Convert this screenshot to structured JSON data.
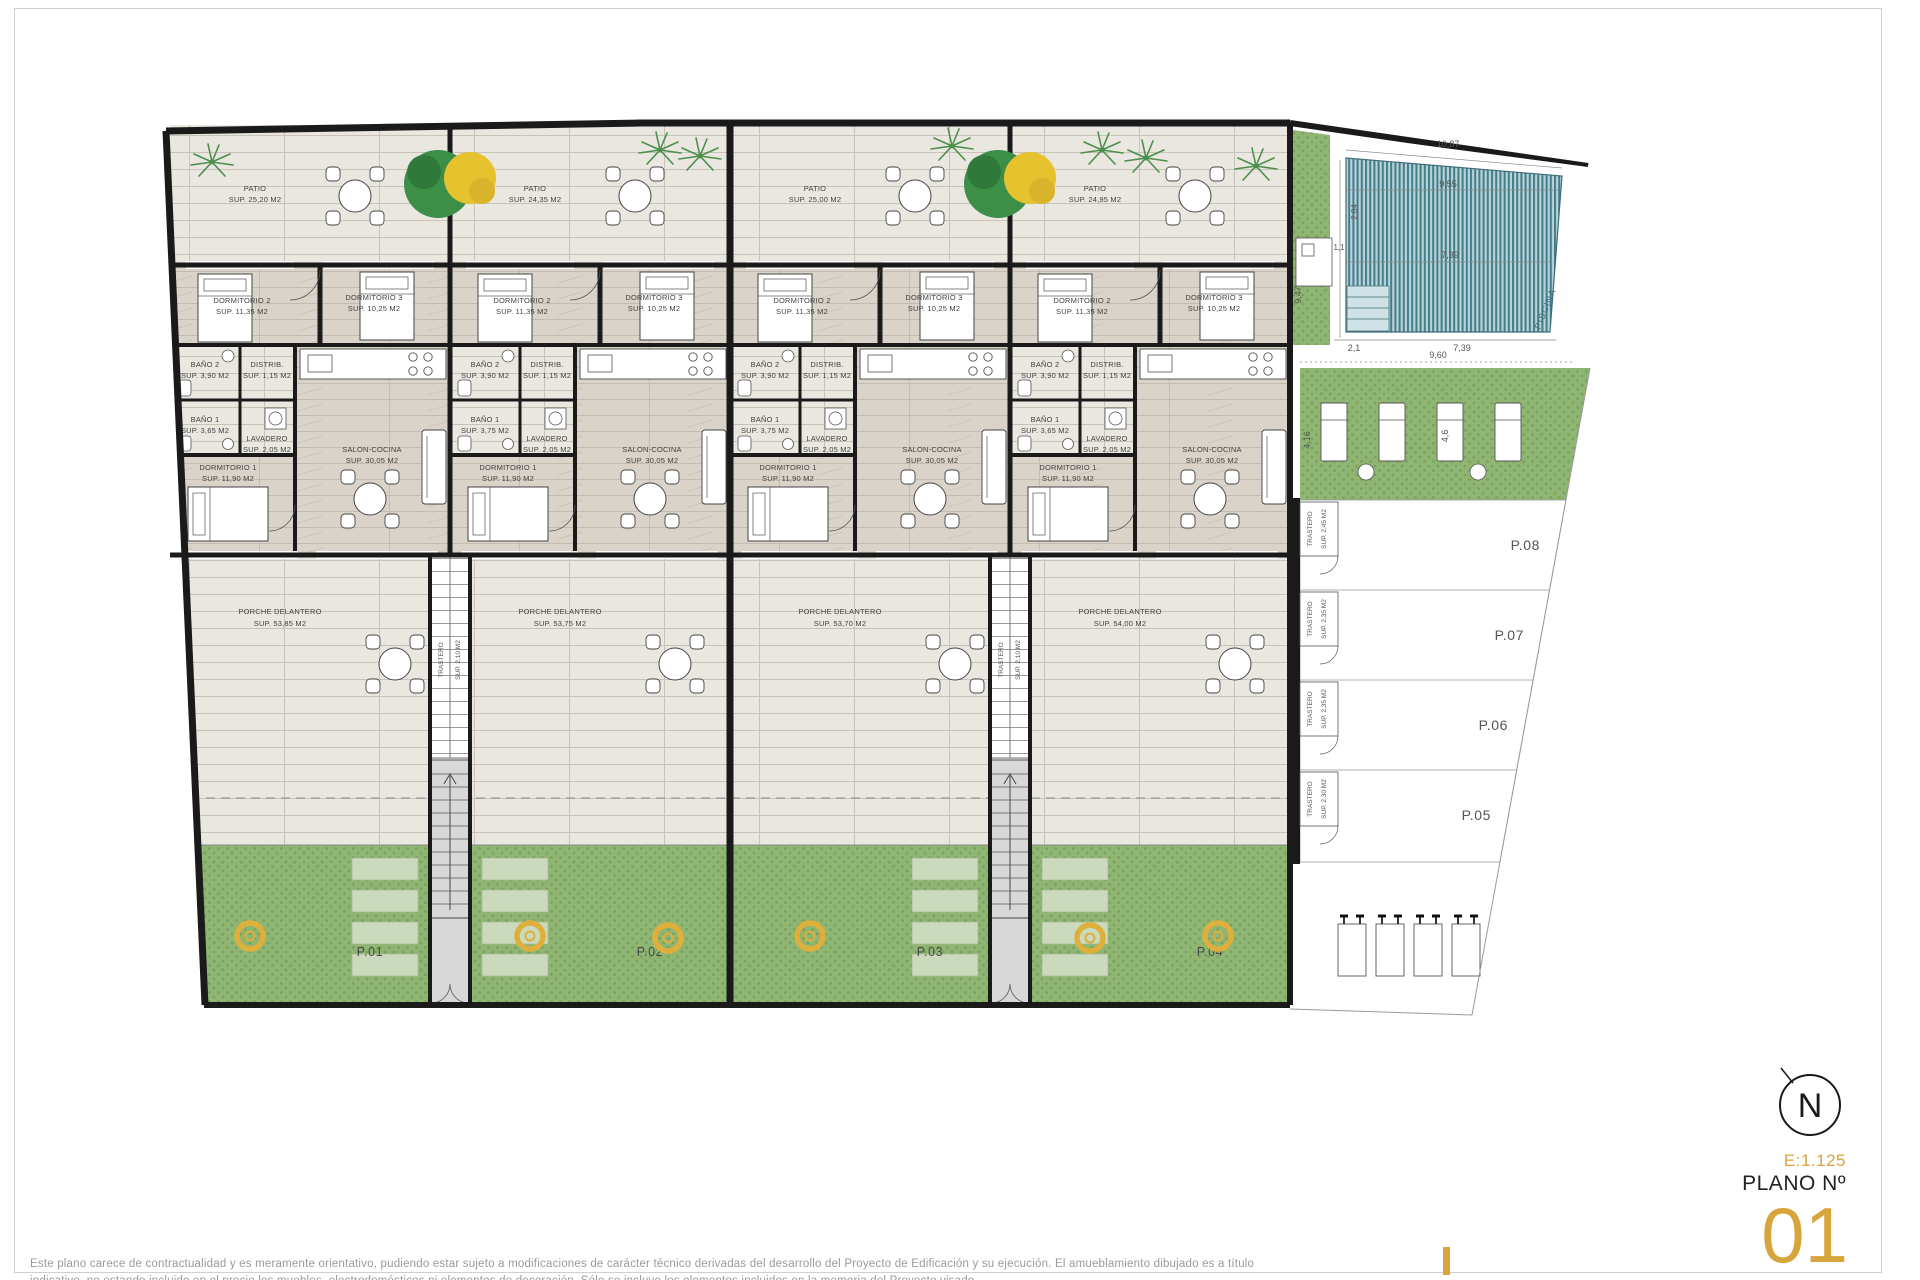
{
  "plan": {
    "trastero_word": "TRASTERO",
    "trastero_strip_area": "SUP. 2,10 M2",
    "patios": [
      {
        "name": "PATIO",
        "area": "SUP. 25,20 M2"
      },
      {
        "name": "PATIO",
        "area": "SUP. 24,35 M2"
      },
      {
        "name": "PATIO",
        "area": "SUP. 25,00 M2"
      },
      {
        "name": "PATIO",
        "area": "SUP. 24,95 M2"
      }
    ],
    "units": [
      {
        "garden_id": "P.01",
        "porche": {
          "name": "PORCHE DELANTERO",
          "area": "SUP. 53,85 M2"
        },
        "rooms": {
          "dorm2": {
            "name": "DORMITORIO 2",
            "area": "SUP. 11,35 M2"
          },
          "dorm3": {
            "name": "DORMITORIO 3",
            "area": "SUP. 10,25 M2"
          },
          "bano2": {
            "name": "BAÑO 2",
            "area": "SUP. 3,90 M2"
          },
          "distrib": {
            "name": "DISTRIB.",
            "area": "SUP. 1,15 M2"
          },
          "bano1": {
            "name": "BAÑO 1",
            "area": "SUP. 3,65 M2"
          },
          "lavadero": {
            "name": "LAVADERO",
            "area": "SUP. 2,05 M2"
          },
          "salon": {
            "name": "SALON-COCINA",
            "area": "SUP. 30,05 M2"
          },
          "dorm1": {
            "name": "DORMITORIO 1",
            "area": "SUP. 11,90 M2"
          }
        }
      },
      {
        "garden_id": "P.02",
        "porche": {
          "name": "PORCHE DELANTERO",
          "area": "SUP. 53,75 M2"
        },
        "rooms": {
          "dorm2": {
            "name": "DORMITORIO 2",
            "area": "SUP. 11,35 M2"
          },
          "dorm3": {
            "name": "DORMITORIO 3",
            "area": "SUP. 10,25 M2"
          },
          "bano2": {
            "name": "BAÑO 2",
            "area": "SUP. 3,90 M2"
          },
          "distrib": {
            "name": "DISTRIB.",
            "area": "SUP. 1,15 M2"
          },
          "bano1": {
            "name": "BAÑO 1",
            "area": "SUP. 3,75 M2"
          },
          "lavadero": {
            "name": "LAVADERO",
            "area": "SUP. 2,05 M2"
          },
          "salon": {
            "name": "SALON-COCINA",
            "area": "SUP. 30,05 M2"
          },
          "dorm1": {
            "name": "DORMITORIO 1",
            "area": "SUP. 11,90 M2"
          }
        }
      },
      {
        "garden_id": "P.03",
        "porche": {
          "name": "PORCHE DELANTERO",
          "area": "SUP. 53,70 M2"
        },
        "rooms": {
          "dorm2": {
            "name": "DORMITORIO 2",
            "area": "SUP. 11,35 M2"
          },
          "dorm3": {
            "name": "DORMITORIO 3",
            "area": "SUP. 10,25 M2"
          },
          "bano2": {
            "name": "BAÑO 2",
            "area": "SUP. 3,90 M2"
          },
          "distrib": {
            "name": "DISTRIB.",
            "area": "SUP. 1,15 M2"
          },
          "bano1": {
            "name": "BAÑO 1",
            "area": "SUP. 3,75 M2"
          },
          "lavadero": {
            "name": "LAVADERO",
            "area": "SUP. 2,05 M2"
          },
          "salon": {
            "name": "SALON-COCINA",
            "area": "SUP. 30,05 M2"
          },
          "dorm1": {
            "name": "DORMITORIO 1",
            "area": "SUP. 11,90 M2"
          }
        }
      },
      {
        "garden_id": "P.04",
        "porche": {
          "name": "PORCHE DELANTERO",
          "area": "SUP. 54,00 M2"
        },
        "rooms": {
          "dorm2": {
            "name": "DORMITORIO 2",
            "area": "SUP. 11,35 M2"
          },
          "dorm3": {
            "name": "DORMITORIO 3",
            "area": "SUP. 10,25 M2"
          },
          "bano2": {
            "name": "BAÑO 2",
            "area": "SUP. 3,90 M2"
          },
          "distrib": {
            "name": "DISTRIB.",
            "area": "SUP. 1,15 M2"
          },
          "bano1": {
            "name": "BAÑO 1",
            "area": "SUP. 3,65 M2"
          },
          "lavadero": {
            "name": "LAVADERO",
            "area": "SUP. 2,05 M2"
          },
          "salon": {
            "name": "SALON-COCINA",
            "area": "SUP. 30,05 M2"
          },
          "dorm1": {
            "name": "DORMITORIO 1",
            "area": "SUP. 11,90 M2"
          }
        }
      }
    ],
    "parking": [
      {
        "id": "P.08",
        "trastero_area": "SUP. 2,45 M2"
      },
      {
        "id": "P.07",
        "trastero_area": "SUP. 2,35 M2"
      },
      {
        "id": "P.06",
        "trastero_area": "SUP. 2,35 M2"
      },
      {
        "id": "P.05",
        "trastero_area": "SUP. 2,30 M2"
      }
    ],
    "pool": {
      "label": "PISCINA",
      "dim_top": "10,87",
      "dim_top2": "9,55",
      "dim_mid": "7,39",
      "dim_small": "1,1",
      "dim_bottom_left": "2,1",
      "dim_bottom": "7,39",
      "dim_left_v": "9,47",
      "dim_inner_v": "2,84",
      "dim_below": "9,60",
      "dim_garden_left_v": "4,16",
      "dim_garden_right_v": "4,6"
    }
  },
  "titleblock": {
    "north_letter": "N",
    "scale": "E:1.125",
    "plano_label": "PLANO Nº",
    "plano_number": "01"
  },
  "disclaimer": {
    "line1": "Este plano carece de contractualidad y es meramente orientativo, pudiendo estar sujeto a modificaciones de carácter técnico derivadas del desarrollo del Proyecto de Edificación y su ejecución. El amueblamiento dibujado es a título",
    "line2": "indicativo, no estando incluido en el precio los muebles, electrodomésticos ni elementos de decoración. Sólo se incluye los elementos incluidos en la memoria del Proyecto visado."
  },
  "colors": {
    "accent_gold": "#D8A43C",
    "wall": "#1A1A1A",
    "grass": "#8FB573",
    "pool_stripe": "#427D8C",
    "disclaimer_text": "#9A9A9A"
  }
}
